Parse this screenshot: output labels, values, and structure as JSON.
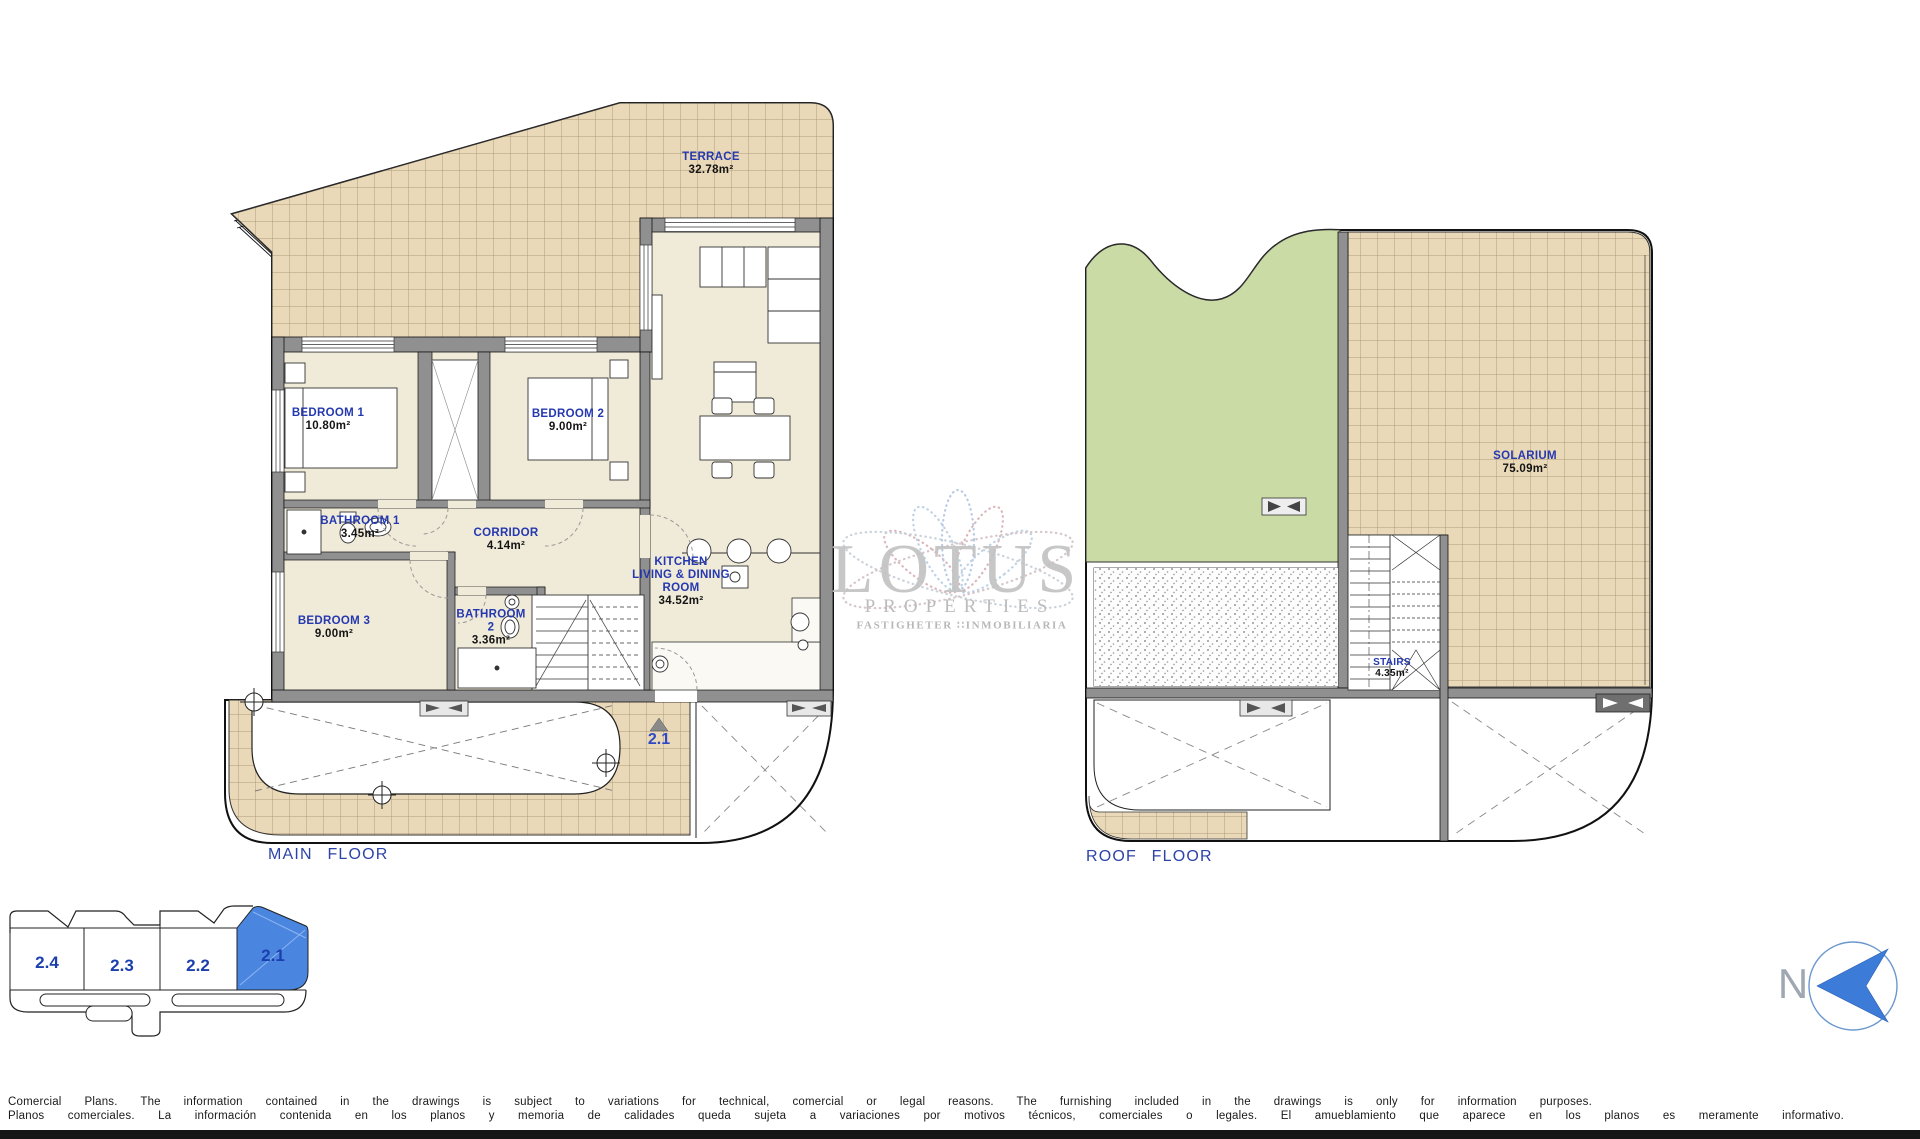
{
  "main_floor": {
    "title": "MAIN FLOOR",
    "entrance_unit": "2.1",
    "rooms": {
      "terrace": {
        "name": "TERRACE",
        "area": "32.78m²"
      },
      "bedroom1": {
        "name": "BEDROOM 1",
        "area": "10.80m²"
      },
      "bedroom2": {
        "name": "BEDROOM 2",
        "area": "9.00m²"
      },
      "bathroom1": {
        "name": "BATHROOM 1",
        "area": "3.45m²"
      },
      "corridor": {
        "name": "CORRIDOR",
        "area": "4.14m²"
      },
      "bedroom3": {
        "name": "BEDROOM 3",
        "area": "9.00m²"
      },
      "bathroom2": {
        "line1": "BATHROOM",
        "line2": "2",
        "area": "3.36m²"
      },
      "kitchen": {
        "line1": "KITCHEN",
        "line2": "LIVING & DINING",
        "line3": "ROOM",
        "area": "34.52m²"
      }
    }
  },
  "roof_floor": {
    "title": "ROOF FLOOR",
    "rooms": {
      "solarium": {
        "name": "SOLARIUM",
        "area": "75.09m²"
      },
      "stairs": {
        "name": "STAIRS",
        "area": "4.35m²"
      }
    }
  },
  "unit_selector": {
    "units": [
      "2.4",
      "2.3",
      "2.2",
      "2.1"
    ],
    "highlighted_unit": "2.1"
  },
  "compass": {
    "label": "N"
  },
  "watermark": {
    "name": "LOTUS",
    "subtitle": "PROPERTIES",
    "tagline": "FASTIGHETER ∷INMOBILIARIA"
  },
  "disclaimer": {
    "line_en": "Comercial Plans. The information contained in the drawings is subject to variations for technical, comercial or legal reasons. The furnishing included in the drawings is only for information purposes.",
    "line_es": "Planos comerciales. La información contenida en los planos y memoria de calidades queda sujeta a variaciones por motivos técnicos, comerciales o legales. El amueblamiento que aparece en los planos es meramente informativo."
  },
  "palette": {
    "plan_text_blue": "#2438b0",
    "tile_fill": "#ead9b8",
    "grass_green": "#cbdba6",
    "selected_unit_blue": "#4a86e0",
    "wall_gray": "#909090",
    "watermark_gray": "#c3c3c3"
  }
}
